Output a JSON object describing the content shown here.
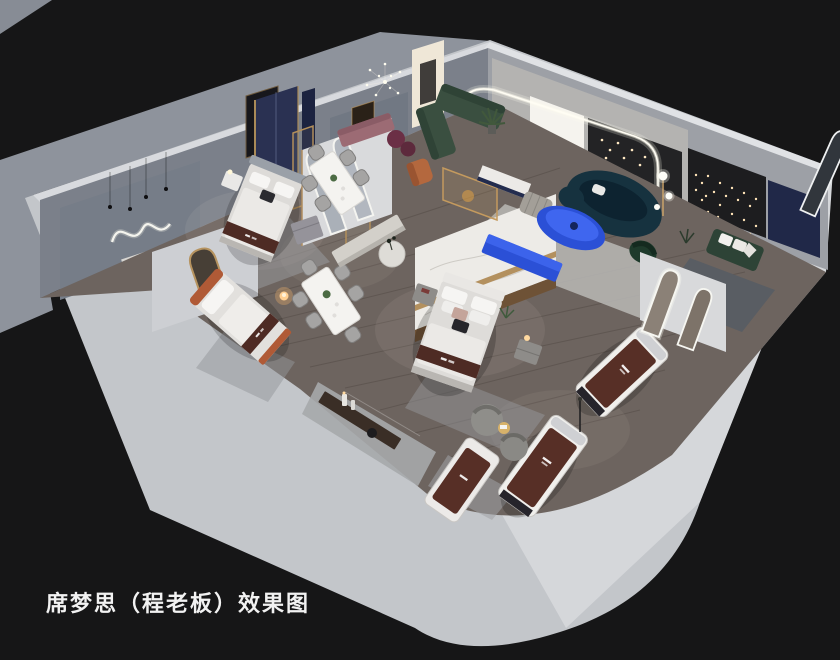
{
  "caption": {
    "text": "席梦思（程老板）效果图"
  },
  "colors": {
    "background": "#161617",
    "backdrop": "#8e939c",
    "wall_band": "#c3c6ca",
    "wall_face_east": "#d5d7da",
    "wall_inner_nw": "#7b808a",
    "wall_inner_ne": "#9da0a6",
    "floor_wood": "#6d645f",
    "accent_blue": "#2b50d6",
    "accent_blue_light": "#3f66ef",
    "sofa_green": "#3a4f40",
    "sofa_teal": "#16323f",
    "runner_brown": "#4e2b24",
    "led_white": "#fffdf4",
    "caption_color": "#f2f2f2"
  }
}
